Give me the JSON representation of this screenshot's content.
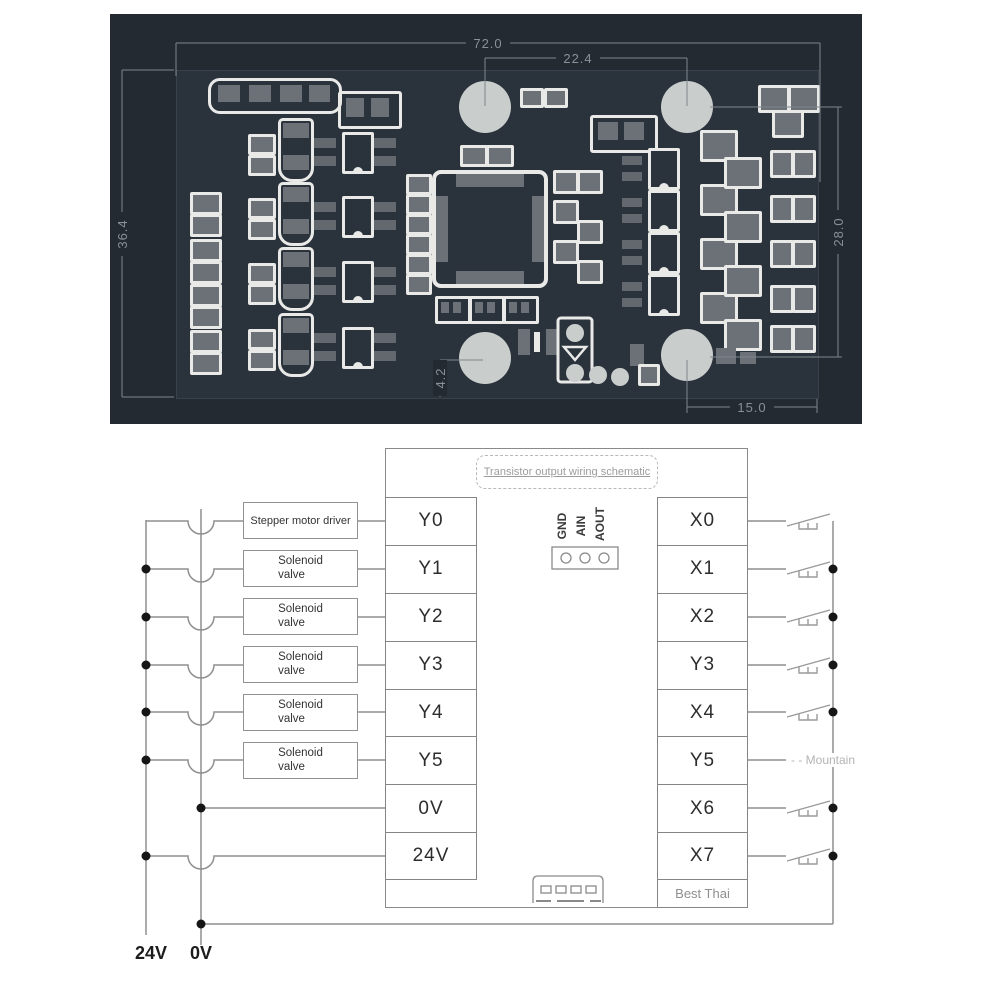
{
  "pcb": {
    "dimensions": {
      "board_width": "72.0",
      "hole_spacing_top": "22.4",
      "board_height": "36.4",
      "hole_spacing_right": "28.0",
      "hole_offset_bottom_right": "15.0",
      "hole_offset_bottom": "4.2"
    },
    "colors": {
      "background": "#232a32",
      "board": "#2a323b",
      "pad": "#6b7177",
      "silkscreen": "#e9eae8",
      "hole": "#c9cdcc",
      "dimension": "#8a9097"
    }
  },
  "schematic": {
    "title": "Transistor output wiring schematic",
    "left_terminals": [
      "Y0",
      "Y1",
      "Y2",
      "Y3",
      "Y4",
      "Y5",
      "0V",
      "24V"
    ],
    "right_terminals": [
      "X0",
      "X1",
      "X2",
      "Y3",
      "X4",
      "Y5",
      "X6",
      "X7"
    ],
    "devices": [
      {
        "line1": "Stepper motor driver",
        "line2": ""
      },
      {
        "line1": "Solenoid",
        "line2": "valve"
      },
      {
        "line1": "Solenoid",
        "line2": "valve"
      },
      {
        "line1": "Solenoid",
        "line2": "valve"
      },
      {
        "line1": "Solenoid",
        "line2": "valve"
      },
      {
        "line1": "Solenoid",
        "line2": "valve"
      }
    ],
    "analog_pins": [
      "GND",
      "AIN",
      "AOUT"
    ],
    "power_labels": {
      "v24": "24V",
      "v0": "0V"
    },
    "watermarks": {
      "mountain": "- - Mountain",
      "best_thai": "Best Thai"
    },
    "colors": {
      "wire": "#8f8f8f",
      "dot": "#161616"
    }
  }
}
